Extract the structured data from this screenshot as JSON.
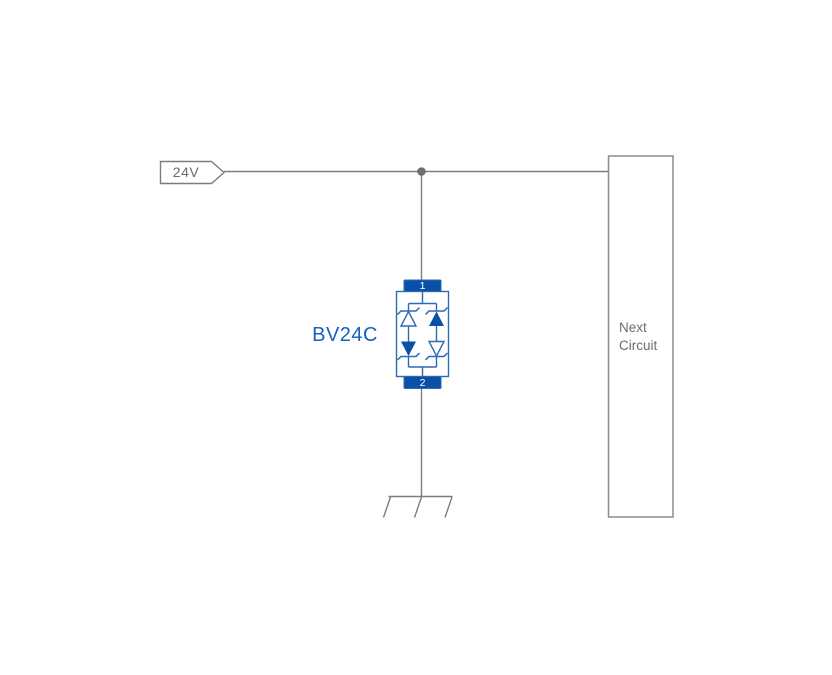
{
  "colors": {
    "background": "#ffffff",
    "wire": "#7b7d7f",
    "junction": "#6d6f71",
    "boxStroke": "#8a8c8e",
    "grayText": "#6a6c6e",
    "blueFill": "#0b50a7",
    "blueStroke": "#2d6ab3",
    "blueText": "#145fc6"
  },
  "net_label": {
    "text": "24V"
  },
  "component": {
    "label": "BV24C",
    "type": "bidirectional-tvs-diode",
    "pins": {
      "top": "1",
      "bottom": "2"
    }
  },
  "next_block": {
    "label": "Next Circuit"
  },
  "symbols": {
    "junction": "wire-junction-dot",
    "ground": "chassis-ground-icon",
    "net_flag": "net-label-flag"
  }
}
